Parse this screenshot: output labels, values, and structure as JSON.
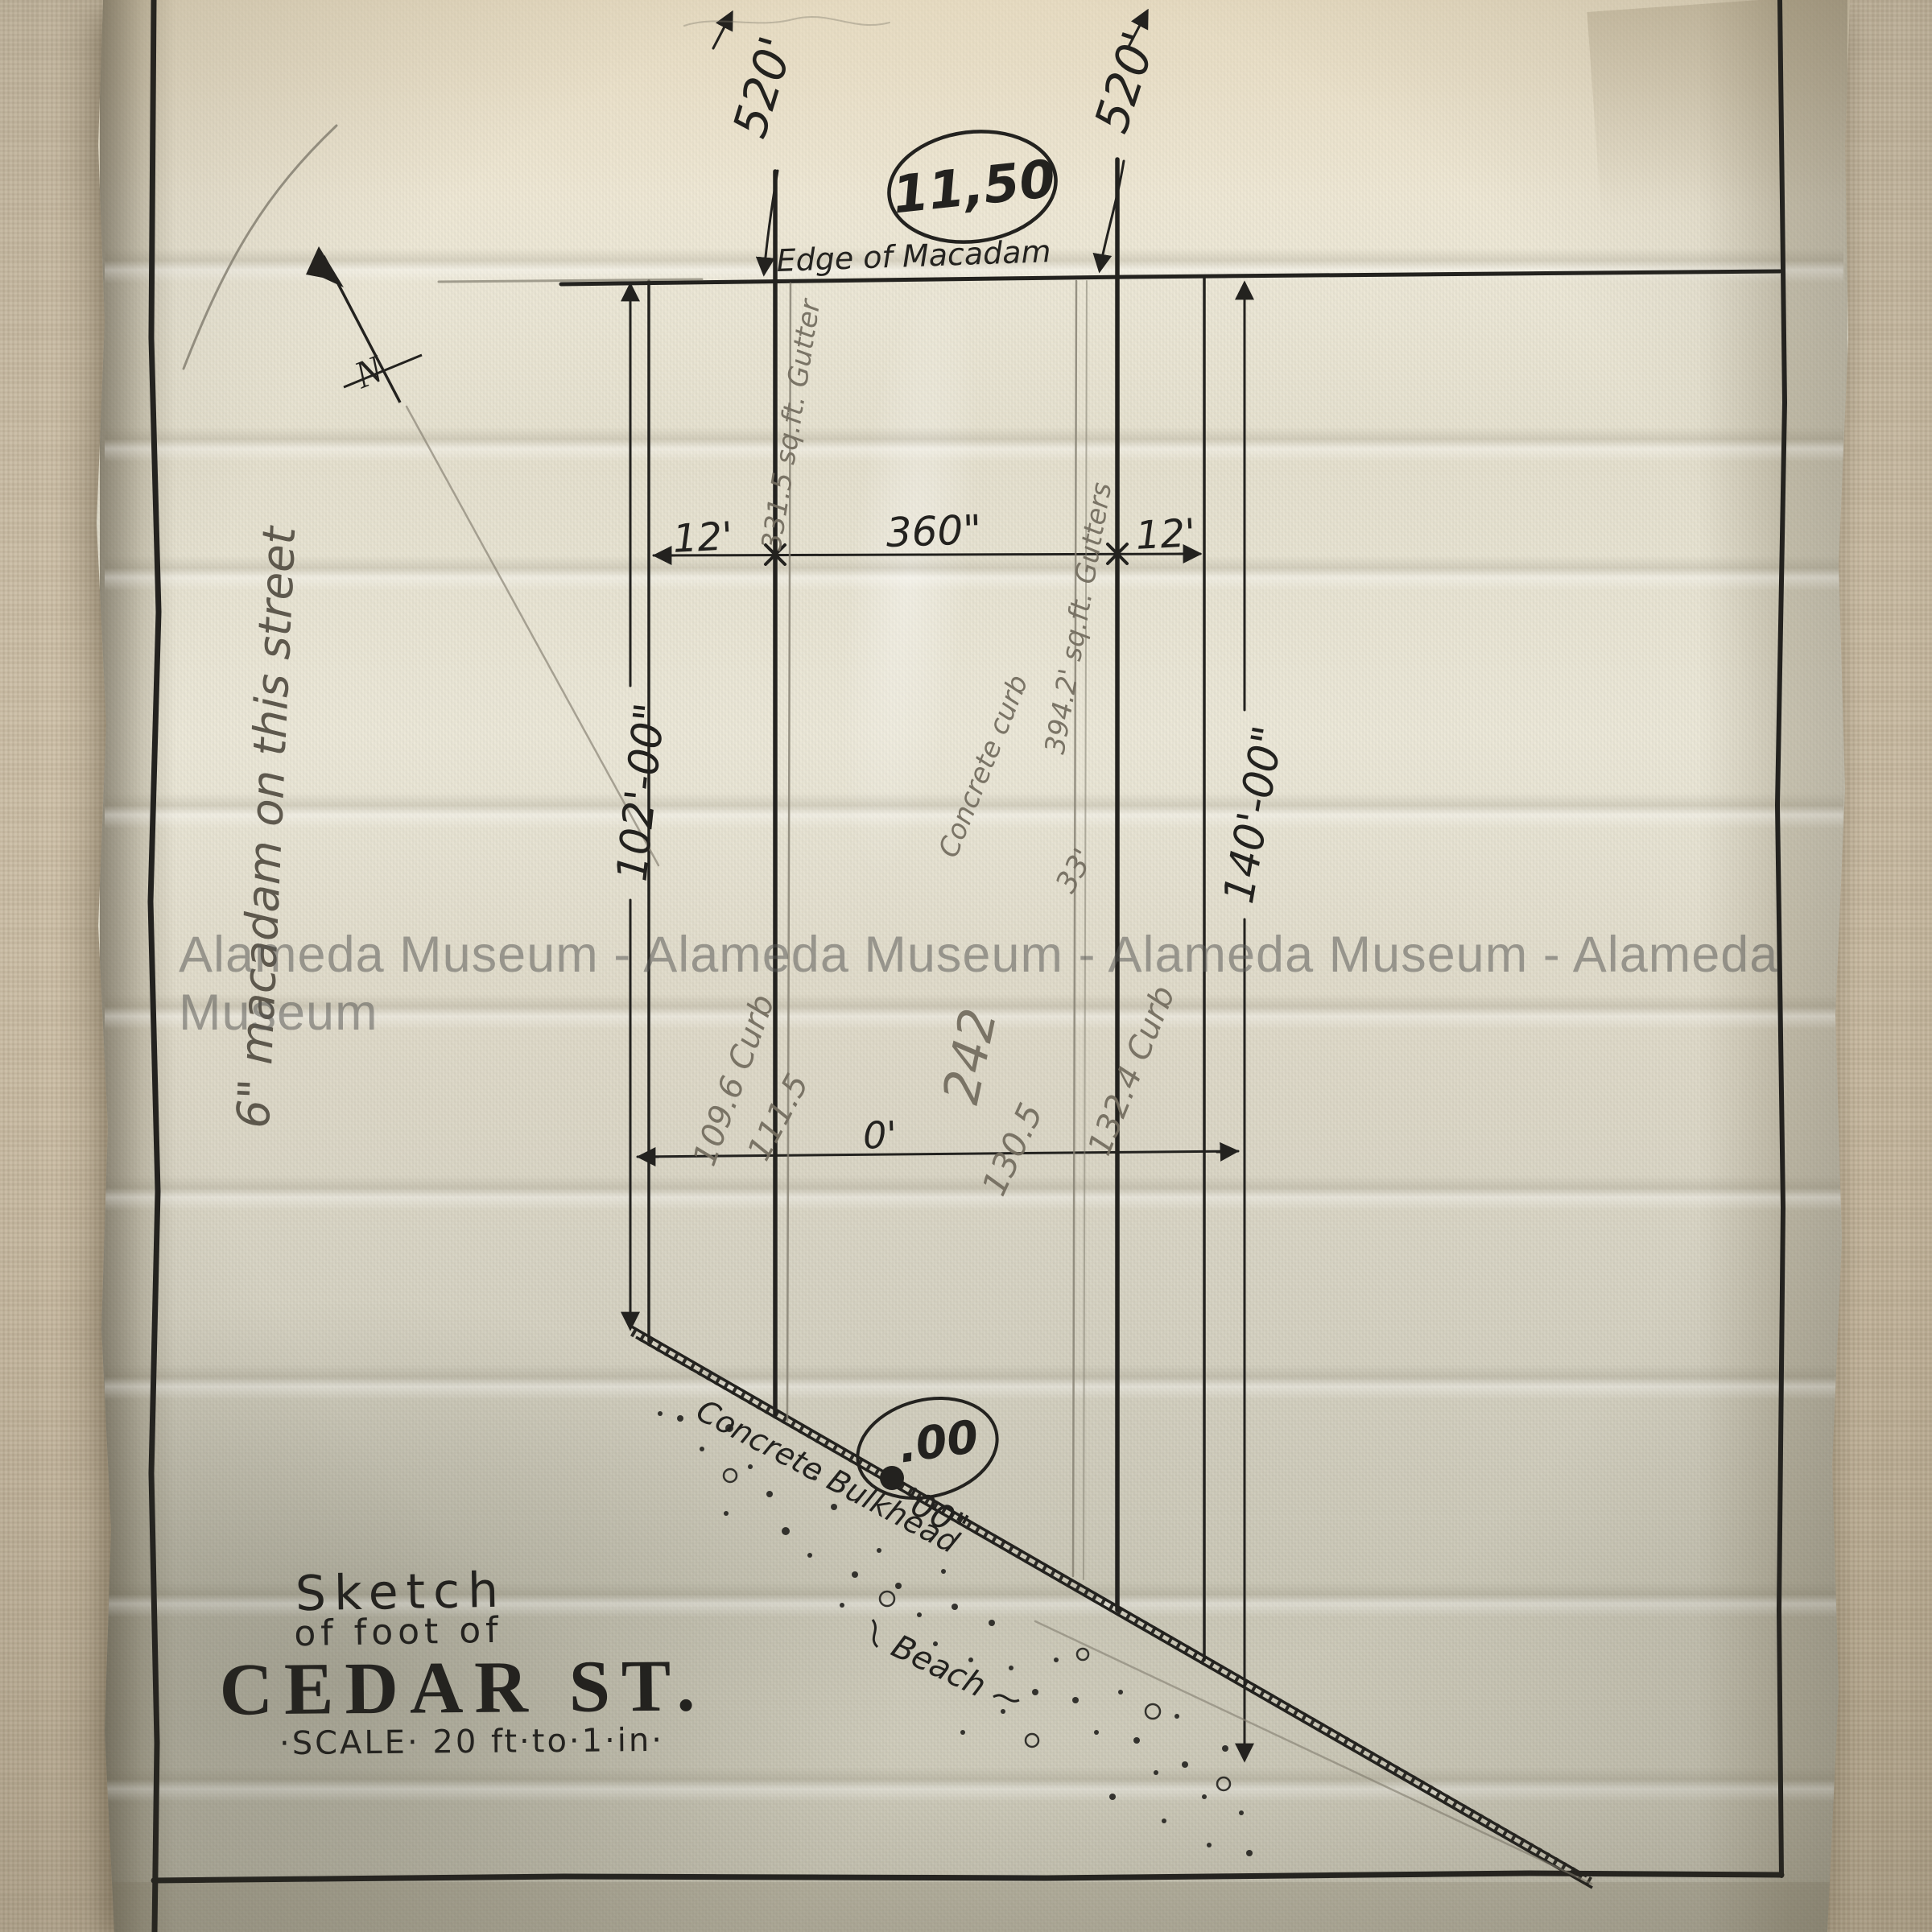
{
  "artifact": {
    "watermark": "Alameda Museum - Alameda Museum - Alameda Museum - Alameda Museum",
    "compass_label": "N"
  },
  "title_block": {
    "line1": "Sketch",
    "line2": "of foot of",
    "line3": "CEDAR ST.",
    "scale": "·SCALE· 20 ft·to·1·in·"
  },
  "ink_labels": {
    "edge_of_macadam": "Edge of Macadam",
    "stamp": "11,50",
    "west_frontage": "520'",
    "east_frontage": "520'",
    "west_depth": "102'-00\"",
    "east_depth": "140'-00\"",
    "gutter_west": "12'",
    "roadway": "360\"",
    "gutter_east": "12'",
    "baseline": "0'",
    "bulkhead": "Concrete Bulkhead",
    "beach": "Beach",
    "bulkhead_oval": ".00",
    "bulkhead_elev": "'00\""
  },
  "pencil_labels": {
    "margin_note": "6\" macadam on this street",
    "gutter_area_west": "331.5 sq.ft. Gutter",
    "gutter_area_east": "394.2' sq.ft. Gutters",
    "curb_west_a": "109.6 Curb",
    "curb_west_b": "111.5",
    "center_a": "242",
    "center_b": "130.5",
    "concrete_curb": "Concrete curb",
    "dim_33": "33'",
    "curb_east": "132.4 Curb"
  }
}
